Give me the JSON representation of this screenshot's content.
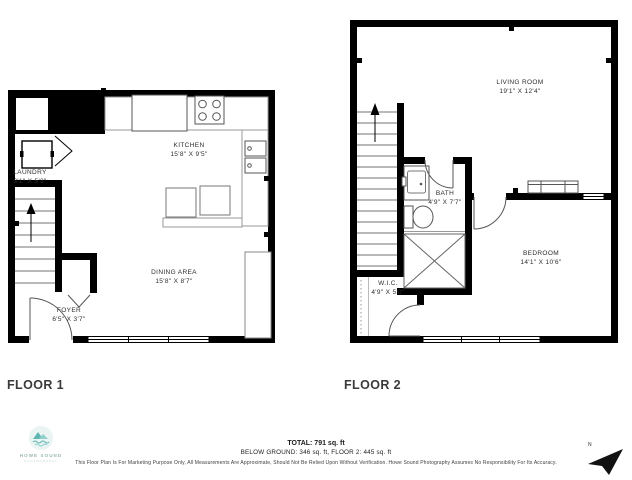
{
  "floor1": {
    "label": "FLOOR 1",
    "rooms": {
      "kitchen": {
        "name": "KITCHEN",
        "dims": "15'8\" X 9'5\""
      },
      "laundry": {
        "name": "LAUNDRY",
        "dims": "3'1\" X 5'3\""
      },
      "dining": {
        "name": "DINING AREA",
        "dims": "15'8\" X 8'7\""
      },
      "foyer": {
        "name": "FOYER",
        "dims": "6'5\" X 3'7\""
      }
    }
  },
  "floor2": {
    "label": "FLOOR 2",
    "rooms": {
      "living": {
        "name": "LIVING ROOM",
        "dims": "19'1\" X 12'4\""
      },
      "bath": {
        "name": "BATH",
        "dims": "4'9\" X 7'7\""
      },
      "bedroom": {
        "name": "BEDROOM",
        "dims": "14'1\" X 10'6\""
      },
      "wic": {
        "name": "W.I.C.",
        "dims": "4'9\" X 5'0\""
      }
    }
  },
  "footer": {
    "total": "TOTAL: 791 sq. ft",
    "breakdown": "BELOW GROUND: 346 sq. ft, FLOOR 2: 445 sq. ft",
    "disclaimer": "This Floor Plan Is For Marketing Purpose Only, All Measurements Are Approximate, Should Not Be Relied Upon Without Verification. Howe Sound Photography Assumes No Responsibility For Its Accuracy."
  },
  "logo": {
    "line1": "HOWE SOUND",
    "line2": "PHOTOGRAPHY"
  },
  "compass": {
    "label": "N"
  },
  "colors": {
    "wall": "#000000",
    "fixture": "#555555",
    "counter": "#999999",
    "logo_teal": "#5fb7b2",
    "text_dark": "#3a3a3a"
  }
}
